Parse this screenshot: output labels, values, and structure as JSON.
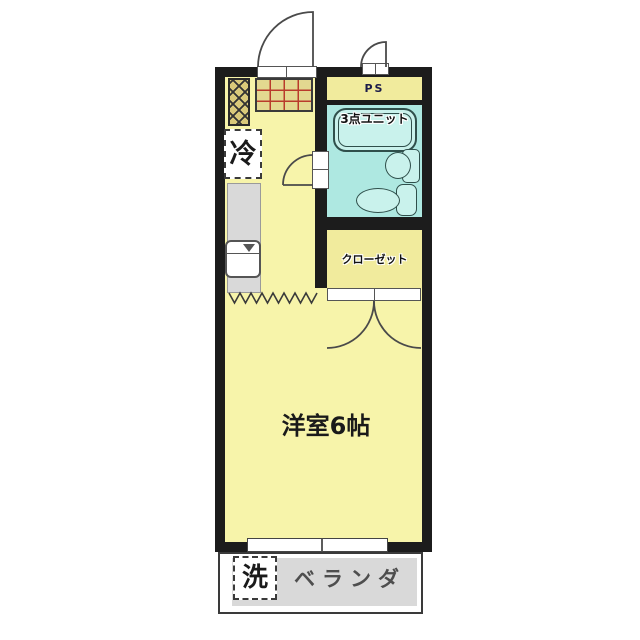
{
  "plan": {
    "labels": {
      "ps": "PS",
      "unit_bath": "3点ユニット",
      "refrigerator": "冷",
      "closet": "クローゼット",
      "main_room": "洋室6帖",
      "veranda": "ベランダ",
      "washer": "洗"
    },
    "colors": {
      "wall": "#1c1c1c",
      "floor_yellow": "#f7f4aa",
      "bath_cyan": "#aee8e1",
      "fixture_fill": "#c9f2ec",
      "service_yellow": "#f1eb9d",
      "counter_gray": "#d9d9d9",
      "veranda_gray": "#d9d9d9",
      "stove_grid_red": "#b93a2c",
      "cabinet_tan": "#d9c97a"
    }
  }
}
